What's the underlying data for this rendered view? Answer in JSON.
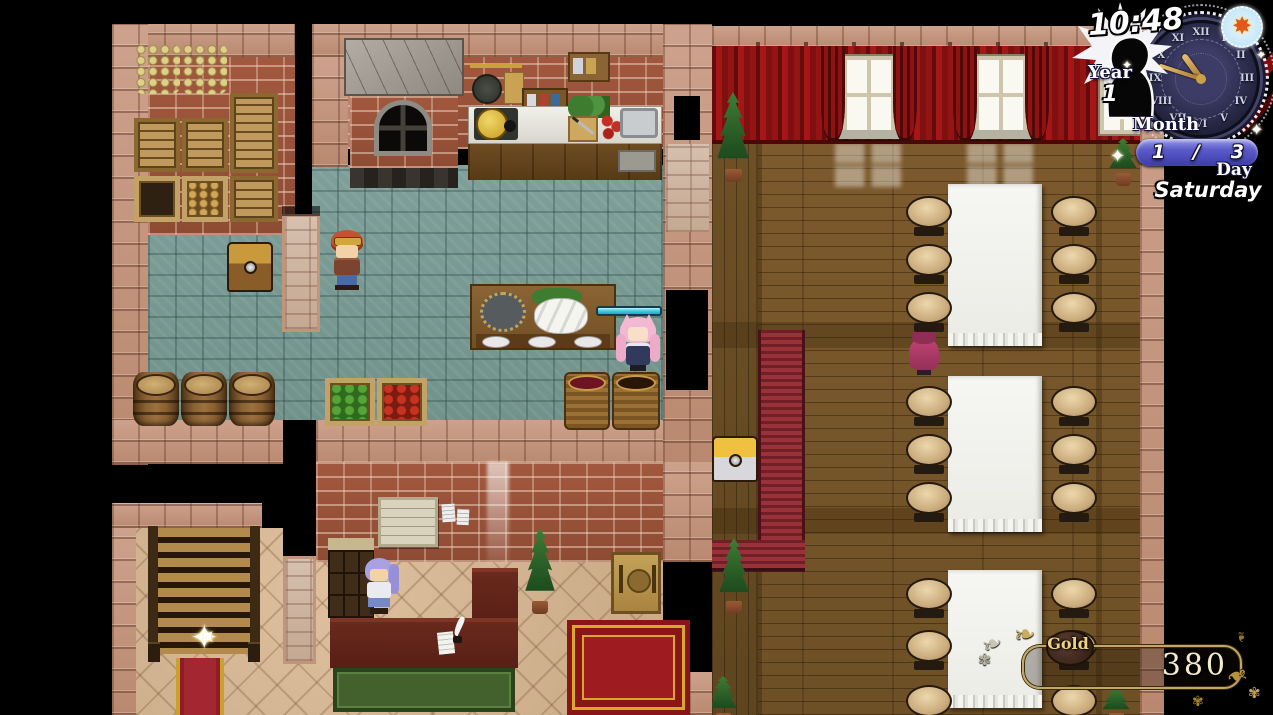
{
  "hud": {
    "clock": {
      "time": "10:48",
      "numerals": [
        "XII",
        "I",
        "II",
        "III",
        "IV",
        "V",
        "VI",
        "VII",
        "VIII",
        "IX",
        "X",
        "XI"
      ],
      "year_label": "Year",
      "year_value": "1",
      "month_label": "Month",
      "month_current": "1",
      "month_separator": "/",
      "month_total": "3",
      "day_label": "Day",
      "day_value": "Saturday",
      "weather_icon": "sun-icon"
    },
    "gold": {
      "label": "Gold",
      "value": "380"
    }
  },
  "icons": {
    "sun": "✸",
    "sparkle": "✦",
    "leaf": "❧",
    "flower": "✾"
  },
  "colors": {
    "gauge_cyan": "#45cfe2",
    "curtain_red": "#8e1212",
    "month_pill_blue": "#4a4ab8",
    "hud_frame_gold": "#c5a765",
    "gold_text": "#f4ecc9"
  },
  "scene": {
    "rooms": [
      "storage-room",
      "kitchen",
      "dining-hall",
      "lobby",
      "staircase"
    ],
    "characters": [
      {
        "id": "hero-boy-goggles"
      },
      {
        "id": "girl-pink-twintails"
      },
      {
        "id": "receptionist-purple-hair"
      },
      {
        "id": "patron-pink-robe"
      }
    ],
    "objects": [
      "treasure-chest",
      "treasure-chest-silver",
      "stone-oven",
      "kitchen-counter",
      "fish-table",
      "barrels",
      "vegetable-crates",
      "baskets",
      "hanging-garlic",
      "storage-crates",
      "notice-board",
      "key-cabinet",
      "reception-counter",
      "menu-sign",
      "red-carpet",
      "carpet-runner",
      "staircase",
      "sparkle",
      "potted-trees",
      "dining-tables",
      "stools",
      "curtains",
      "windows"
    ]
  }
}
